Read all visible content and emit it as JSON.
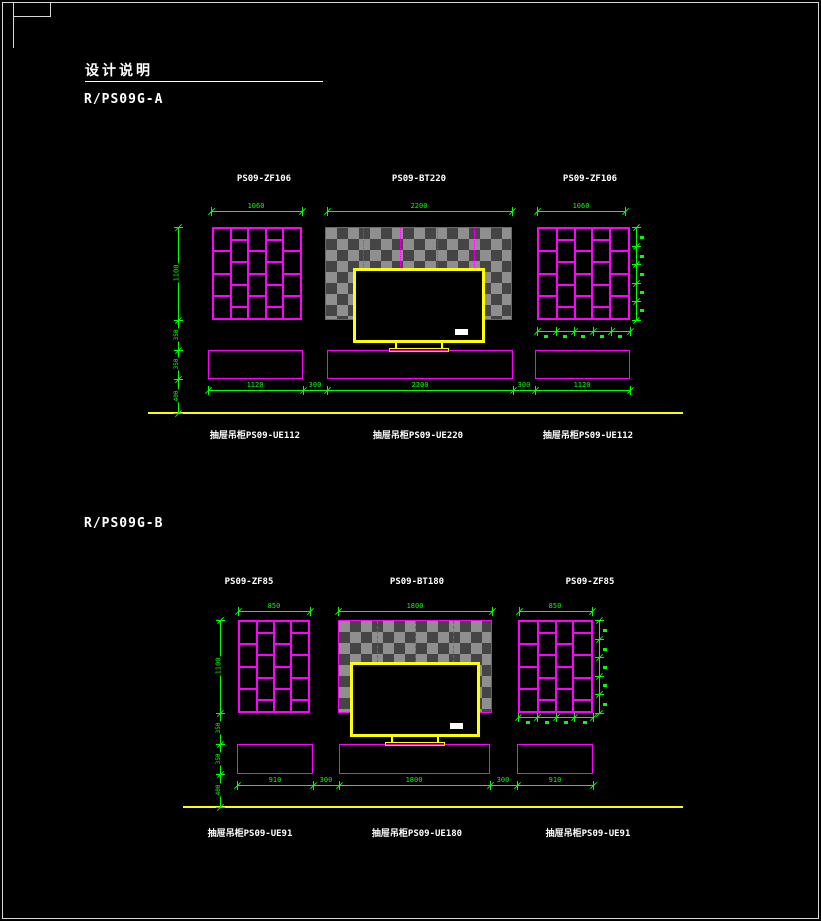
{
  "page": {
    "title": "设计说明",
    "colors": {
      "background": "#000000",
      "dimension_green": "#00ff00",
      "furniture_magenta": "#ff00ff",
      "tv_yellow": "#ffff00",
      "text_white": "#ffffff",
      "hatch_gray": "#8f8f8f"
    }
  },
  "drawing_a": {
    "name": "R/PS09G-A",
    "panel_labels": [
      "PS09-ZF106",
      "PS09-BT220",
      "PS09-ZF106"
    ],
    "top_dims": [
      "1060",
      "2200",
      "1060"
    ],
    "left_dims": [
      "1100",
      "350",
      "350",
      "400"
    ],
    "bottom_dims": [
      "1120",
      "300",
      "2200",
      "300",
      "1120"
    ],
    "cabinet_labels": [
      "抽屉吊柜PS09-UE112",
      "抽屉吊柜PS09-UE220",
      "抽屉吊柜PS09-UE112"
    ]
  },
  "drawing_b": {
    "name": "R/PS09G-B",
    "panel_labels": [
      "PS09-ZF85",
      "PS09-BT180",
      "PS09-ZF85"
    ],
    "top_dims": [
      "850",
      "1800",
      "850"
    ],
    "left_dims": [
      "1100",
      "350",
      "350",
      "400"
    ],
    "bottom_dims": [
      "910",
      "300",
      "1800",
      "300",
      "910"
    ],
    "cabinet_labels": [
      "抽屉吊柜PS09-UE91",
      "抽屉吊柜PS09-UE180",
      "抽屉吊柜PS09-UE91"
    ]
  }
}
